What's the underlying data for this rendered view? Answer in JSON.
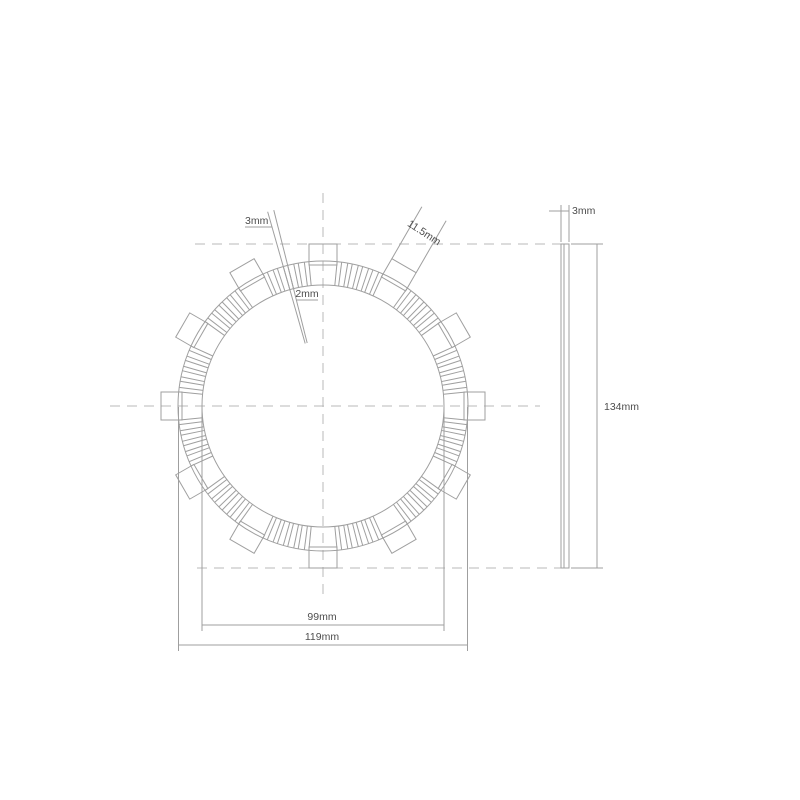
{
  "page": {
    "background": "#ffffff"
  },
  "colors": {
    "line": "#9f9f9f",
    "centerline": "#b8b8b8",
    "text": "#4e4e4e"
  },
  "front_view": {
    "labels": {
      "groove_width_outer": "3mm",
      "groove_width_inner": "2mm",
      "tab_width": "11.5mm",
      "friction_inner_diameter": "99mm",
      "friction_outer_diameter": "119mm"
    }
  },
  "side_view": {
    "labels": {
      "thickness": "3mm",
      "overall_diameter": "134mm"
    }
  }
}
